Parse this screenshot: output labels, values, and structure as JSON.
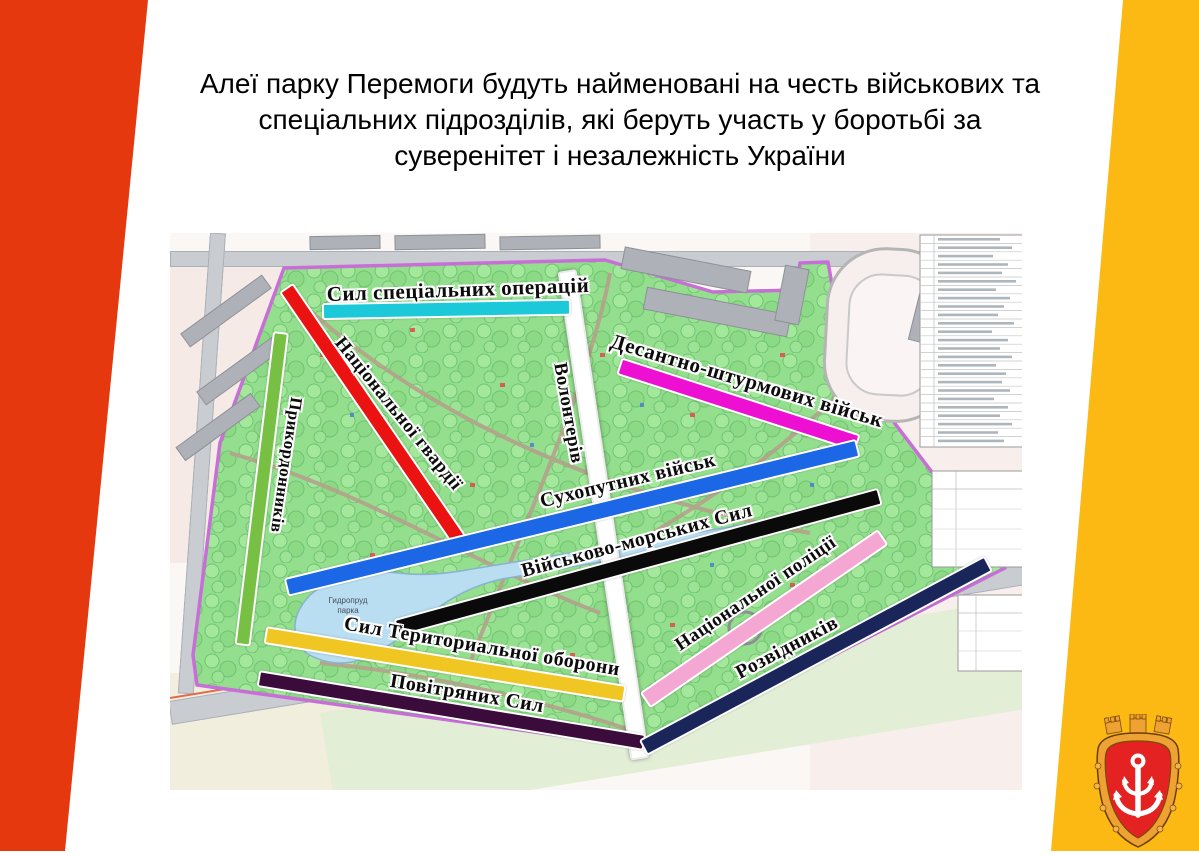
{
  "slide": {
    "title_lines": [
      "Алеї парку Перемоги будуть найменовані на честь військових та",
      "спеціальних підрозділів, які беруть участь у боротьбі за",
      "суверенітет і незалежність України"
    ]
  },
  "map": {
    "alleys": [
      {
        "id": "special-operations-forces",
        "label": "Сил спеціальних операцій",
        "color": "#1cc9d9"
      },
      {
        "id": "national-guard",
        "label": "Національної гвардії",
        "color": "#ea1312"
      },
      {
        "id": "border-guards",
        "label": "Прикордонників",
        "color": "#77c044"
      },
      {
        "id": "volunteers",
        "label": "Волонтерів",
        "color": "#ffffff"
      },
      {
        "id": "air-assault-troops",
        "label": "Десантно-штурмових військ",
        "color": "#ee10d2"
      },
      {
        "id": "ground-forces",
        "label": "Сухопутних військ",
        "color": "#1b67e6"
      },
      {
        "id": "naval-forces",
        "label": "Військово-морських Сил",
        "color": "#0a0a0a"
      },
      {
        "id": "territorial-defense-forces",
        "label": "Сил Териториальної оборони",
        "color": "#f0c722"
      },
      {
        "id": "air-forces",
        "label": "Повітряних Сил",
        "color": "#3a0b3b"
      },
      {
        "id": "national-police",
        "label": "Національної поліції",
        "color": "#f4a7d3"
      },
      {
        "id": "scouts",
        "label": "Розвідників",
        "color": "#1a2559"
      }
    ],
    "lake_label_line1": "Гидропруд",
    "lake_label_line2": "парка"
  },
  "decor": {
    "left_band_color": "#e6380e",
    "right_band_color": "#fcb813",
    "emblem": {
      "name": "odesa-coat-of-arms",
      "shield_color": "#e52222",
      "frame_color": "#eda233",
      "anchor_color": "#ffffff"
    }
  }
}
